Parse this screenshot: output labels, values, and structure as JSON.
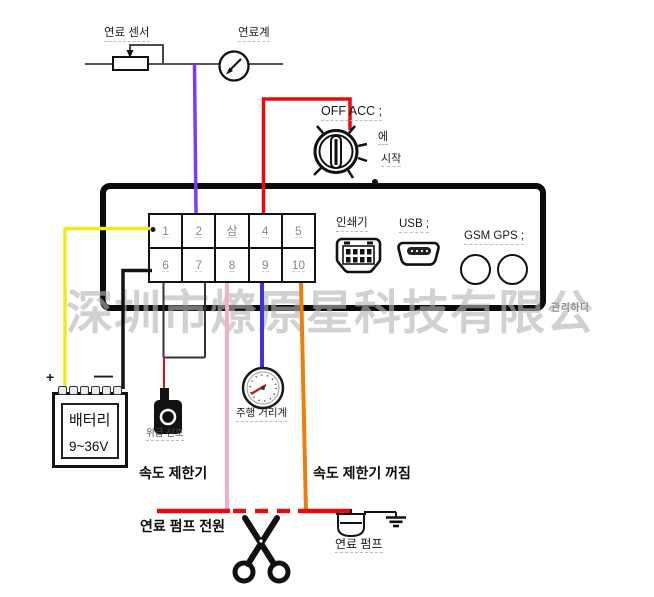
{
  "watermark": "深圳市燎原星科技有限公",
  "fuel_sensor": {
    "label": "연료 센서"
  },
  "fuel_gauge": {
    "label": "연료계"
  },
  "ignition": {
    "title": "OFF ACC ;",
    "on_label": "에",
    "start_label": "시작"
  },
  "device": {
    "terminals": [
      "1",
      "2",
      "삼",
      "4",
      "5",
      "6",
      "7",
      "8",
      "9",
      "10"
    ],
    "printer_label": "인쇄기",
    "usb_label": "USB ;",
    "gsm_gps_label": "GSM GPS ;",
    "manage_label": "관리하다"
  },
  "battery": {
    "name": "배터리",
    "voltage": "9~36V",
    "plus": "+",
    "minus": "—"
  },
  "emergency_signal_label": "위급 신호",
  "odometer_label": "주행 거리계",
  "speed_limiter_label": "속도 제한기",
  "speed_limiter_off_label": "속도 제한기 꺼짐",
  "fuel_pump_power_label": "연료 펌프 전원",
  "fuel_pump_label": "연료 펌프",
  "colors": {
    "wire-yellow": "#f2ea12",
    "wire-purple": "#7b3cf0",
    "wire-red": "#e80b0b",
    "wire-pink": "#f9aacd",
    "wire-blue": "#4431df",
    "wire-orange": "#ef7d0b",
    "wire-black": "#121212",
    "watermark-gray": "#b5b5b5"
  }
}
